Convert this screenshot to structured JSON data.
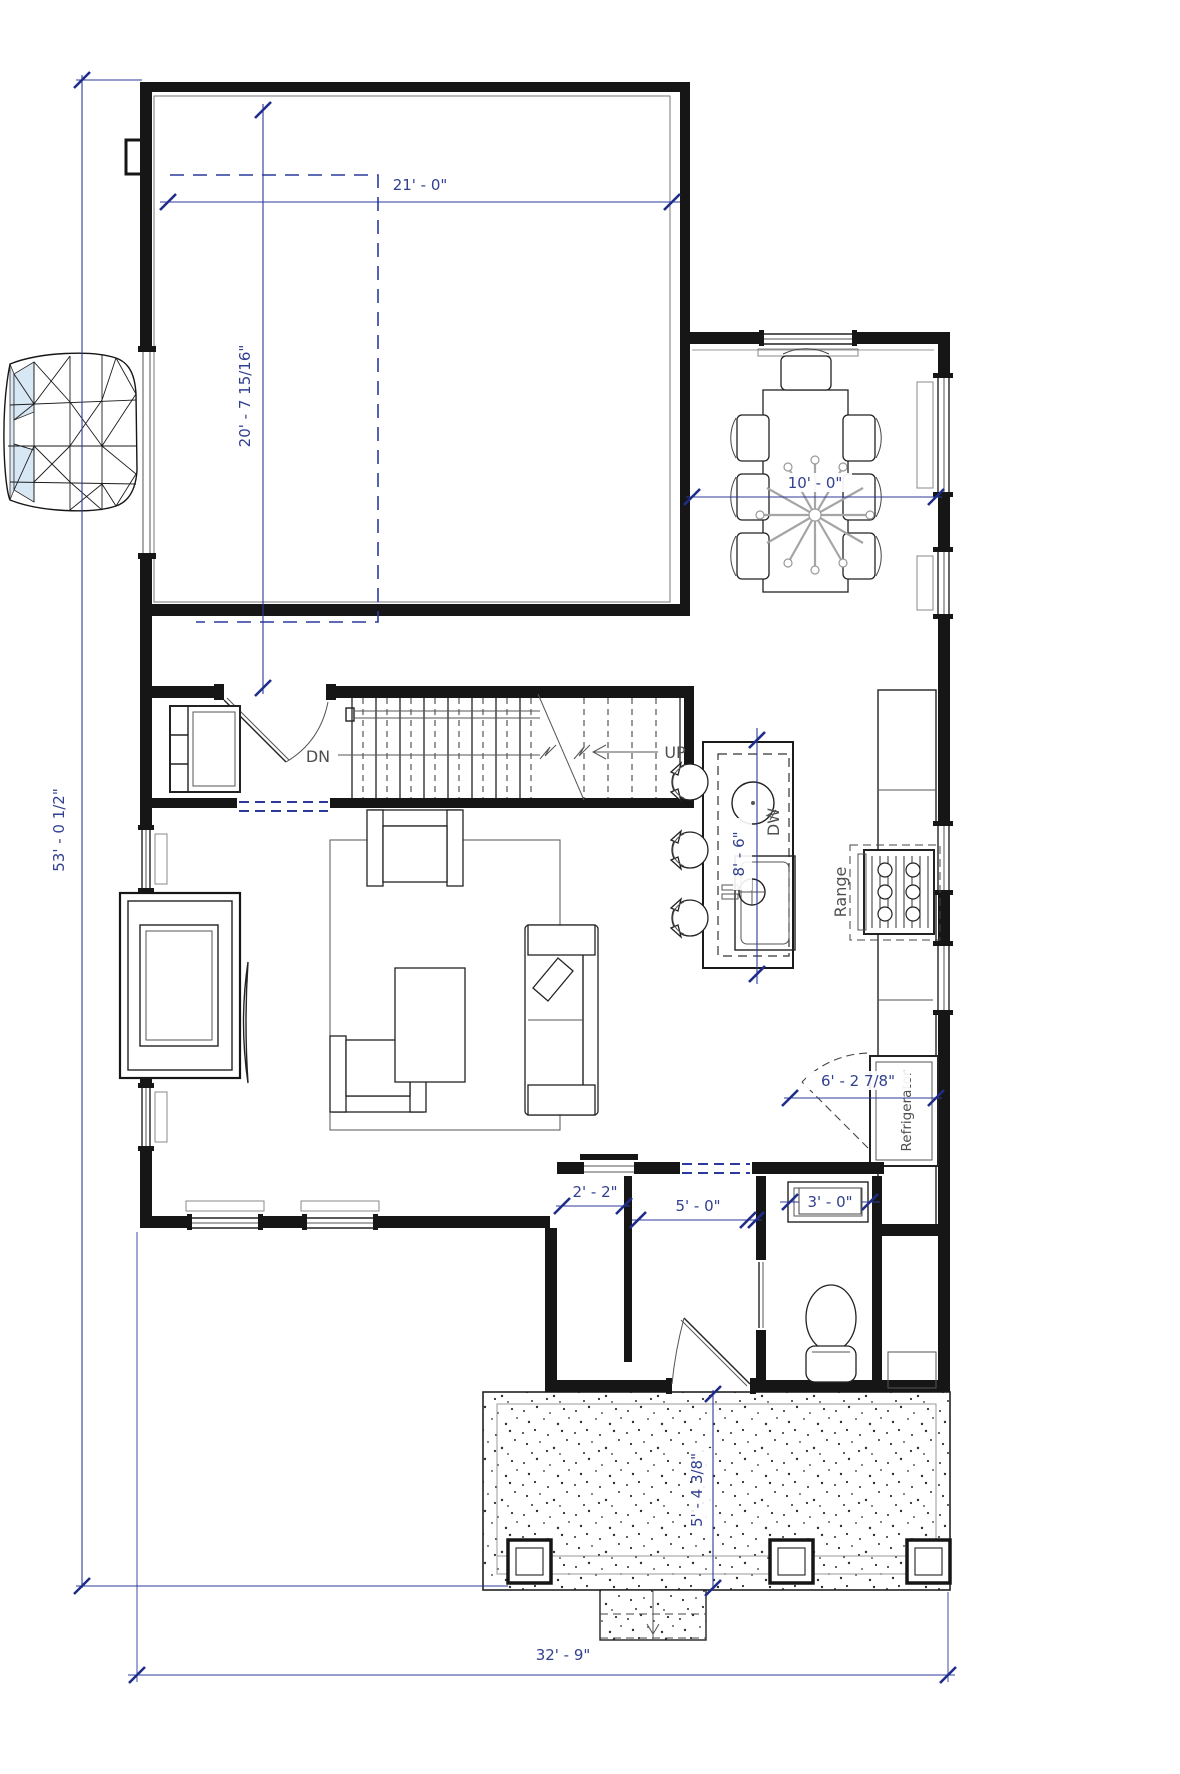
{
  "title": "First Floor Plan",
  "colors": {
    "wall": "#161616",
    "dimension_line": "#2c3a9e",
    "dimension_text": "#31408f",
    "annotation_text": "#4f4f4f",
    "car_glass": "#d8e7f4",
    "background": "#ffffff"
  },
  "dims": {
    "overall_height": "53' - 0 1/2\"",
    "overall_width": "32' - 9\"",
    "garage_width": "21' - 0\"",
    "garage_depth": "20' - 7 15/16\"",
    "dining_width": "10' - 0\"",
    "island_length": "8' - 6\"",
    "closet_width": "2' - 2\"",
    "hall_width": "5' - 0\"",
    "bath_window_width": "3' - 0\"",
    "fridge_run": "6' - 2 7/8\"",
    "porch_depth": "5' - 4 3/8\""
  },
  "labels": {
    "stairs_down": "DN",
    "stairs_up": "UP",
    "dishwasher": "DW",
    "range": "Range",
    "refrigerator": "Refrigerator"
  }
}
